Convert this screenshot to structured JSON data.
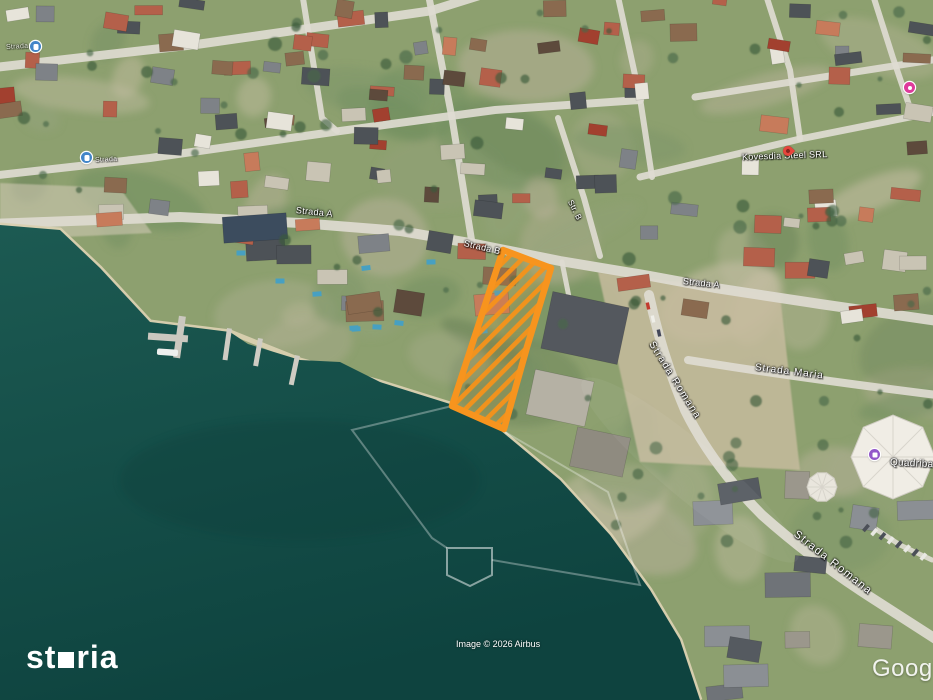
{
  "map": {
    "attribution": "Image © 2026 Airbus",
    "google_watermark": "Google",
    "branding": {
      "name": "storia",
      "prefix": "st",
      "suffix": "ria"
    },
    "highlighted_plot": {
      "outline_color": "#F7941E",
      "hatch_color": "#F5921A",
      "points": "503,250 551,268 527,347 504,429 452,406"
    },
    "street_labels": [
      {
        "text": "Strada",
        "x": 6,
        "y": 44,
        "rot": -3,
        "size": 7,
        "op": 0.75
      },
      {
        "text": "Strada",
        "x": 95,
        "y": 157,
        "rot": -3,
        "size": 7,
        "op": 0.8
      },
      {
        "text": "Strada A",
        "x": 296,
        "y": 205,
        "rot": 6,
        "size": 9
      },
      {
        "text": "Strada B",
        "x": 464,
        "y": 238,
        "rot": 13,
        "size": 9
      },
      {
        "text": "Str. B",
        "x": 570,
        "y": 196,
        "rot": 63,
        "size": 8
      },
      {
        "text": "Strada A",
        "x": 683,
        "y": 276,
        "rot": 6,
        "size": 9
      },
      {
        "text": "Kovesdia Steel SRL",
        "x": 742,
        "y": 152,
        "rot": -2,
        "size": 9
      },
      {
        "text": "Strada Romana",
        "x": 651,
        "y": 337,
        "rot": 58,
        "size": 10,
        "ls": 1.5
      },
      {
        "text": "Strada Maria",
        "x": 755,
        "y": 362,
        "rot": 7,
        "size": 10,
        "ls": 1
      },
      {
        "text": "Strada Romana",
        "x": 795,
        "y": 527,
        "rot": 38,
        "size": 11,
        "ls": 1.5
      },
      {
        "text": "Quadriba",
        "x": 890,
        "y": 457,
        "rot": 3,
        "size": 10
      }
    ],
    "pois": [
      {
        "name": "bus-stop-icon",
        "type": "bus",
        "x": 30,
        "y": 41,
        "color": "#4285c8"
      },
      {
        "name": "bus-stop-icon",
        "type": "bus",
        "x": 81,
        "y": 152,
        "color": "#4285c8"
      },
      {
        "name": "business-pin-icon",
        "type": "pin",
        "x": 783,
        "y": 146,
        "color": "#e7453c"
      },
      {
        "name": "lodging-icon",
        "type": "sq",
        "x": 869,
        "y": 449,
        "color": "#9257c9"
      },
      {
        "name": "shopping-icon",
        "type": "circ",
        "x": 904,
        "y": 82,
        "color": "#de3a9b"
      }
    ]
  },
  "scene": {
    "water_color_top": "#1c5a52",
    "water_color_deep": "#0e433f",
    "land_color": "#8da06f",
    "road_color": "#dedbd1",
    "beach_color": "#d9d0b0"
  }
}
